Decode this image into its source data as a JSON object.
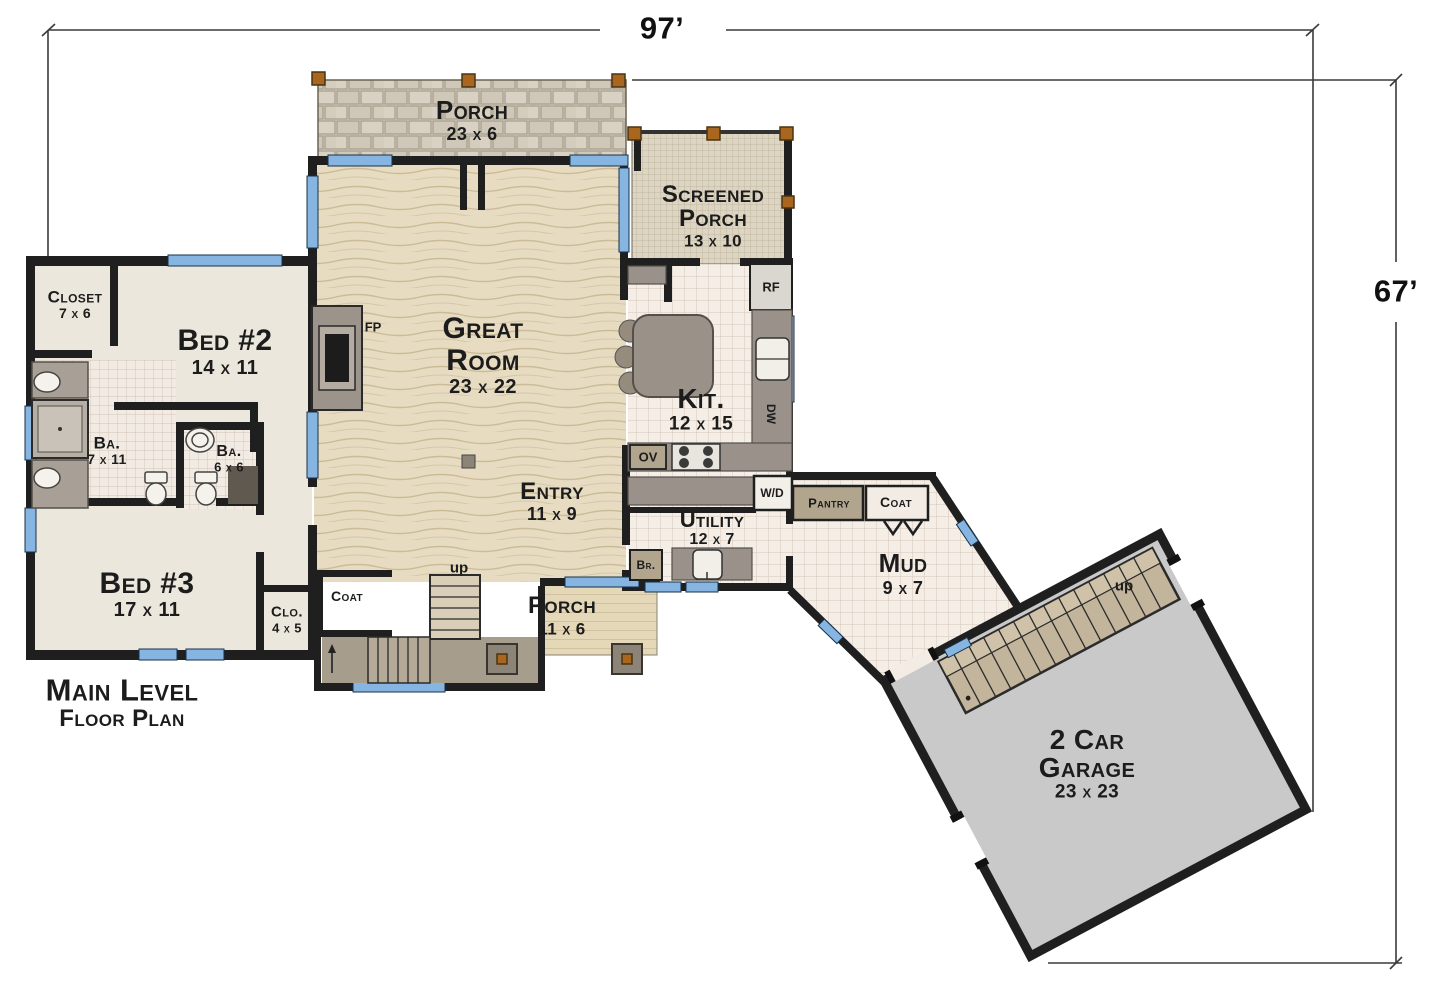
{
  "dimensions": {
    "width_label": "97’",
    "height_label": "67’"
  },
  "title": {
    "line1": "Main Level",
    "line2": "Floor Plan"
  },
  "rooms": {
    "porch_top": {
      "name": "Porch",
      "size": "23 x 6"
    },
    "screened_porch": {
      "name1": "Screened",
      "name2": "Porch",
      "size": "13 x 10"
    },
    "great_room": {
      "name1": "Great",
      "name2": "Room",
      "size": "23 x 22"
    },
    "kitchen": {
      "name": "Kit.",
      "size": "12 x 15"
    },
    "closet": {
      "name": "Closet",
      "size": "7 x 6"
    },
    "bed2": {
      "name": "Bed #2",
      "size": "14 x 11"
    },
    "bath7": {
      "name": "Ba.",
      "size": "7 x 11"
    },
    "bath6": {
      "name": "Ba.",
      "size": "6 x 6"
    },
    "bed3": {
      "name": "Bed #3",
      "size": "17 x 11"
    },
    "entry": {
      "name": "Entry",
      "size": "11 x 9"
    },
    "coat_left": {
      "name": "Coat"
    },
    "clo": {
      "name": "Clo.",
      "size": "4 x 5"
    },
    "porch_bottom": {
      "name": "Porch",
      "size": "11 x 6"
    },
    "utility": {
      "name": "Utility",
      "size": "12 x 7"
    },
    "pantry": {
      "name": "Pantry"
    },
    "coat_right": {
      "name": "Coat"
    },
    "mud": {
      "name": "Mud",
      "size": "9 x 7"
    },
    "garage": {
      "name1": "2 Car",
      "name2": "Garage",
      "size": "23 x 23"
    }
  },
  "fixtures": {
    "fireplace": "FP",
    "fridge": "RF",
    "dishwasher": "DW",
    "oven": "OV",
    "washer_dryer": "W/D",
    "broom_closet": "Br.",
    "stairs_up_main": "up",
    "stairs_up_garage": "up"
  },
  "colors": {
    "wall": "#1f1f1f",
    "window": "#86b5e1",
    "wood": "#e7dcc2",
    "stone": "#d5cec0",
    "tile": "#f4eee7",
    "garage_floor": "#c9c9c9",
    "counter": "#99918a"
  }
}
